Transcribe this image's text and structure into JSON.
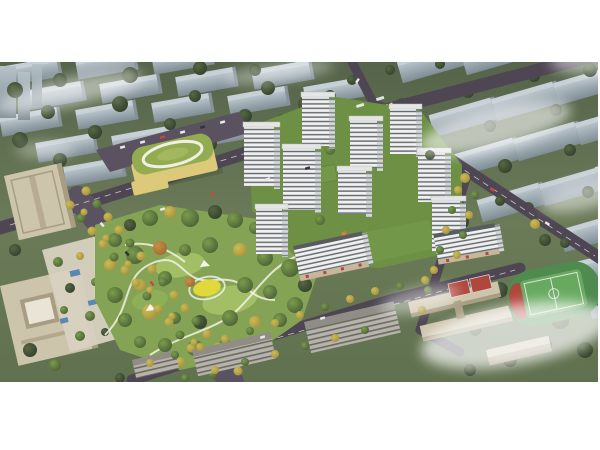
{
  "scene": {
    "type": "aerial-architectural-rendering",
    "description": "Bird's-eye architectural rendering of a residential masterplan: a cluster of white mid-rise apartment towers around landscaped courtyards, a large central park with winding white paths and a yellow playground, a kindergarten with a green roof and white oval track, a tree-lined boulevard, beige office towers on the left, a school campus with red courts and a green sports field at lower right, all surrounded by rows of existing slab housing blocks under drifting white fog.",
    "elements": {
      "residential_towers": 9,
      "residential_slabs_with_retail": 2,
      "kindergarten": 1,
      "central_park": 1,
      "playground": 1,
      "office_towers": 2,
      "school_buildings": 2,
      "basketball_courts": 2,
      "sports_field": 1,
      "boulevard": 1,
      "background_housing_rows": "multiple",
      "fog_patches": 8
    }
  },
  "palette": {
    "canvas_bg": "#ffffff",
    "grass_top": "#55644a",
    "grass_mid": "#6b7b58",
    "grass_low": "#60714f",
    "glass_hi": "#b6c1c8",
    "glass_lo": "#7f8d95",
    "slab_roof": "#c7d0d6",
    "slab_side": "#87929b",
    "tree_green_hi": "#7b9c4c",
    "tree_green_lo": "#4a6036",
    "tree_dark_hi": "#556842",
    "tree_dark_lo": "#333f2c",
    "tree_yellow_hi": "#cdbb55",
    "tree_yellow_lo": "#a3913e",
    "tree_orange_hi": "#c98f45",
    "tree_orange_lo": "#9c6a33",
    "road": "#4e4653",
    "road_light": "#5a5260",
    "lane_mark": "#e9e9e4",
    "park_base": "#85a355",
    "lawn": "#a2bf65",
    "path": "#f1f1e8",
    "playground": "#e3d83b",
    "tower_face": "#f0f1ef",
    "tower_stripe": "#60666e",
    "tower_side": "#d2d6d5",
    "tower_side_stripe": "#7b8289",
    "tower_roof": "#e4e6e5",
    "dark_roof": "#585c60",
    "retail_base": "#c8b69c",
    "roof_garden": "#74984a",
    "kg_roof": "#93ac51",
    "kg_body": "#dcca7a",
    "beige_hi": "#cdc4ac",
    "beige_lo": "#a89d82",
    "gray_face": "#b6b3ab",
    "gray_stripe": "#6c6963",
    "gray_roof": "#908d86",
    "plaza": "#d8d2c1",
    "canopy_blue": "#5b87b5",
    "pitch": "#67aa5f",
    "pitch_dark": "#4f8a4e",
    "court_red": "#b0473d",
    "car_red": "#c44a3e",
    "car_dark": "#30343a",
    "fog": "#ffffff"
  }
}
